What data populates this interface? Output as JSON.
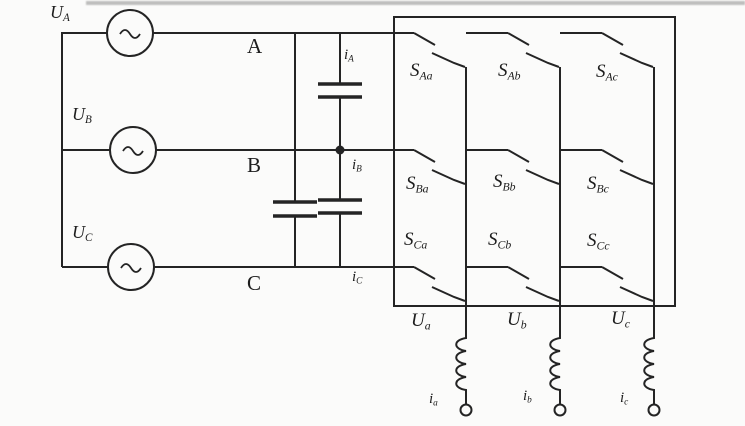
{
  "diagram": {
    "type": "three-phase matrix converter circuit",
    "colors": {
      "line": "#242424",
      "background": "#fbfbfa",
      "scan_artifact": "#9e9e9e"
    },
    "sources": [
      {
        "label": {
          "main": "U",
          "sub": "A"
        }
      },
      {
        "label": {
          "main": "U",
          "sub": "B"
        }
      },
      {
        "label": {
          "main": "U",
          "sub": "C"
        }
      }
    ],
    "phase_lines": [
      {
        "label": "A"
      },
      {
        "label": "B"
      },
      {
        "label": "C"
      }
    ],
    "input_currents": [
      {
        "main": "i",
        "sub": "A"
      },
      {
        "main": "i",
        "sub": "B"
      },
      {
        "main": "i",
        "sub": "C"
      }
    ],
    "switches": [
      {
        "main": "S",
        "sub": "Aa"
      },
      {
        "main": "S",
        "sub": "Ab"
      },
      {
        "main": "S",
        "sub": "Ac"
      },
      {
        "main": "S",
        "sub": "Ba"
      },
      {
        "main": "S",
        "sub": "Bb"
      },
      {
        "main": "S",
        "sub": "Bc"
      },
      {
        "main": "S",
        "sub": "Ca"
      },
      {
        "main": "S",
        "sub": "Cb"
      },
      {
        "main": "S",
        "sub": "Cc"
      }
    ],
    "output_voltages": [
      {
        "main": "U",
        "sub": "a"
      },
      {
        "main": "U",
        "sub": "b"
      },
      {
        "main": "U",
        "sub": "c"
      }
    ],
    "output_currents": [
      {
        "main": "i",
        "sub": "a"
      },
      {
        "main": "i",
        "sub": "b"
      },
      {
        "main": "i",
        "sub": "c"
      }
    ]
  }
}
